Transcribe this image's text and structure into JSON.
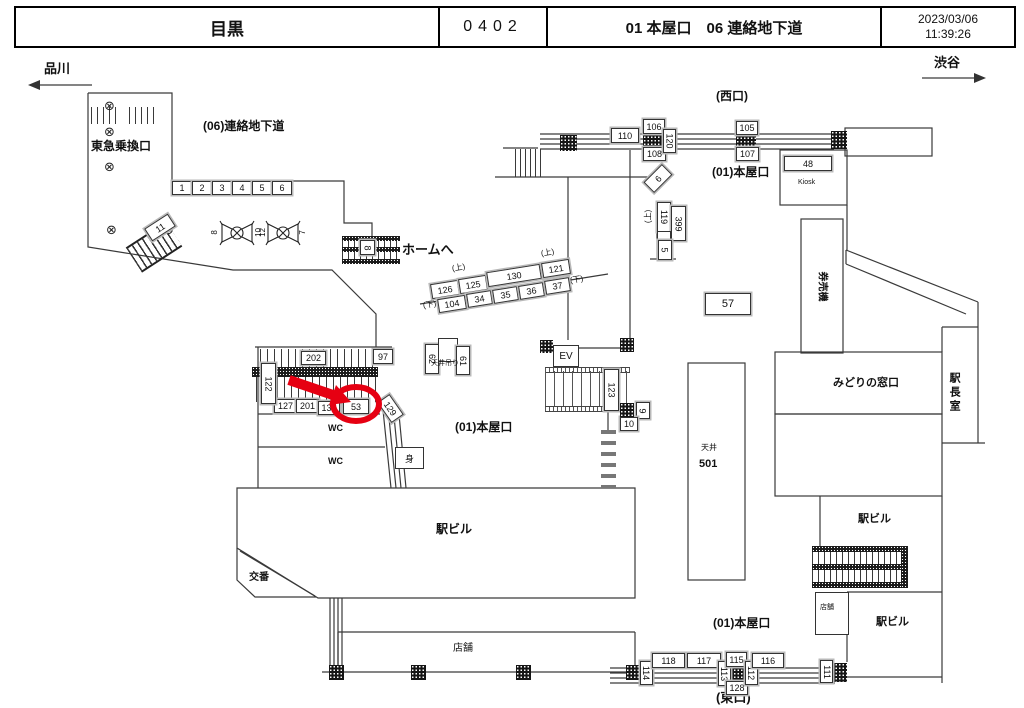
{
  "header": {
    "station": "目黒",
    "code": "0402",
    "locations": "01 本屋口　06 連絡地下道",
    "date": "2023/03/06",
    "time": "11:39:26"
  },
  "directions": {
    "left": "品川",
    "right": "渋谷"
  },
  "labels": {
    "underpass": "(06)連絡地下道",
    "tokyu_gate": "東急乗換口",
    "west_exit": "(西口)",
    "main_gate_top": "(01)本屋口",
    "kiosk": "Kiosk",
    "ticket_machines": "券売機",
    "to_platform": "ホームへ",
    "up1": "(上)",
    "down1": "(下)",
    "up2": "(上)",
    "down2": "(下)",
    "up3": "(上)",
    "ceiling_hung": "天井吊り",
    "main_gate_center": "(01)本屋口",
    "wc1": "WC",
    "wc2": "WC",
    "accessible": "身",
    "ev": "EV",
    "midori_window": "みどりの窓口",
    "station_master": "駅長室",
    "ceiling": "天井",
    "ceiling_no": "501",
    "bldg_top_right": "駅ビル",
    "bldg_bottom_right": "駅ビル",
    "bldg_main": "駅ビル",
    "shop_small": "店舗",
    "shop_long": "店舗",
    "koban": "交番",
    "main_gate_bottom": "(01)本屋口",
    "east_exit": "(東口)"
  },
  "signs": {
    "underpass_row": [
      "1",
      "2",
      "3",
      "4",
      "5",
      "6"
    ],
    "s11": "11",
    "pillar_a_left": "8",
    "pillar_a_right": "10",
    "pillar_b_left": "12",
    "pillar_b_right": "7",
    "stair8": "8",
    "diag_upper": [
      "126",
      "125",
      "130",
      "121"
    ],
    "diag_lower": [
      "104",
      "34",
      "35",
      "36",
      "37"
    ],
    "v122": "122",
    "s202": "202",
    "s97": "97",
    "row_left": [
      "127",
      "201",
      "131",
      "53"
    ],
    "s129": "129",
    "s62": "62",
    "s61": "61",
    "s110": "110",
    "s106": "106",
    "s108": "108",
    "v120": "120",
    "s105": "105",
    "s107": "107",
    "s48": "48",
    "s57": "57",
    "d6": "6",
    "v119": "119",
    "v399": "399",
    "v5": "5",
    "v123": "123",
    "v9": "9",
    "s10": "10",
    "v114": "114",
    "s118": "118",
    "s117": "117",
    "v113": "113",
    "s115": "115",
    "s128": "128",
    "v112": "112",
    "s116": "116",
    "v111": "111"
  },
  "highlight": {
    "target_sign": "53",
    "color": "#e60012"
  }
}
